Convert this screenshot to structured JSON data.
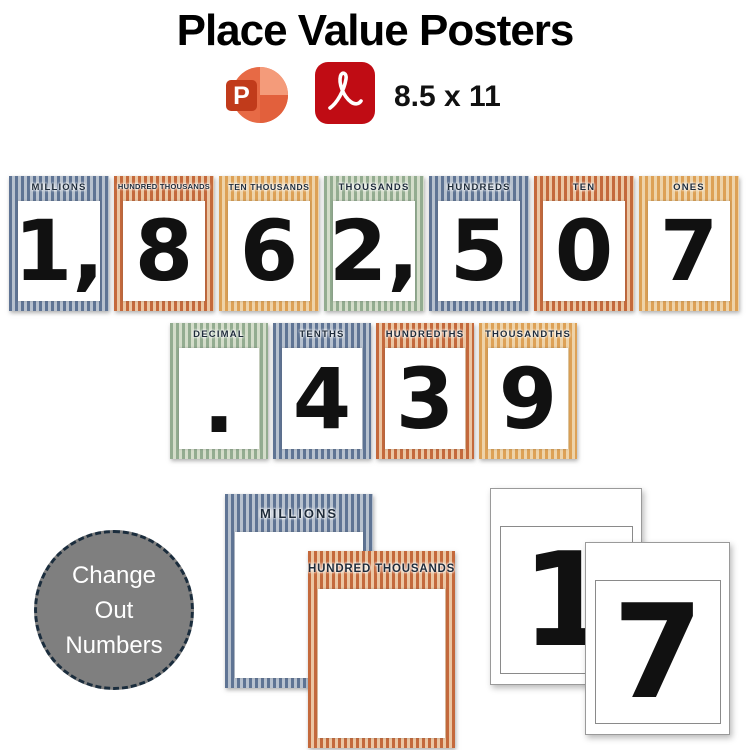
{
  "header": {
    "title": "Place Value Posters",
    "size_label": "8.5 x 11",
    "powerpoint_icon_letter": "P"
  },
  "palette": {
    "blue_dark": "#5F7494",
    "blue_light": "#B7C1CE",
    "orange_dark": "#C4693C",
    "orange_light": "#EBC6A3",
    "gold_dark": "#DDA156",
    "gold_light": "#EED3A9",
    "green_dark": "#93AC90",
    "green_light": "#D4DDCA",
    "label_text": "#1E2B3A",
    "digit_color": "#111111",
    "circle_fill": "#7F7F7F",
    "circle_border": "#1B2D3D",
    "pdf_red": "#C00C14",
    "ppt_coral": "#ED6C47",
    "ppt_dark": "#C13B1B"
  },
  "row1": {
    "cards": [
      {
        "label": "MILLIONS",
        "digit": "1,",
        "theme": "blue"
      },
      {
        "label": "HUNDRED THOUSANDS",
        "digit": "8",
        "theme": "orange"
      },
      {
        "label": "TEN THOUSANDS",
        "digit": "6",
        "theme": "gold"
      },
      {
        "label": "THOUSANDS",
        "digit": "2,",
        "theme": "green"
      },
      {
        "label": "HUNDREDS",
        "digit": "5",
        "theme": "blue"
      },
      {
        "label": "TEN",
        "digit": "0",
        "theme": "orange"
      },
      {
        "label": "ONES",
        "digit": "7",
        "theme": "gold"
      }
    ]
  },
  "row2": {
    "cards": [
      {
        "label": "DECIMAL",
        "digit": ".",
        "theme": "green"
      },
      {
        "label": "TENTHS",
        "digit": "4",
        "theme": "blue"
      },
      {
        "label": "HUNDREDTHS",
        "digit": "3",
        "theme": "orange"
      },
      {
        "label": "THOUSANDTHS",
        "digit": "9",
        "theme": "gold"
      }
    ]
  },
  "bottom": {
    "change_circle": {
      "lines": [
        "Change",
        "Out",
        "Numbers"
      ]
    },
    "posters": [
      {
        "label": "MILLIONS",
        "theme": "blue"
      },
      {
        "label": "HUNDRED THOUSANDS",
        "theme": "orange"
      }
    ],
    "number_pages": [
      {
        "digit": "1"
      },
      {
        "digit": "7"
      }
    ]
  }
}
